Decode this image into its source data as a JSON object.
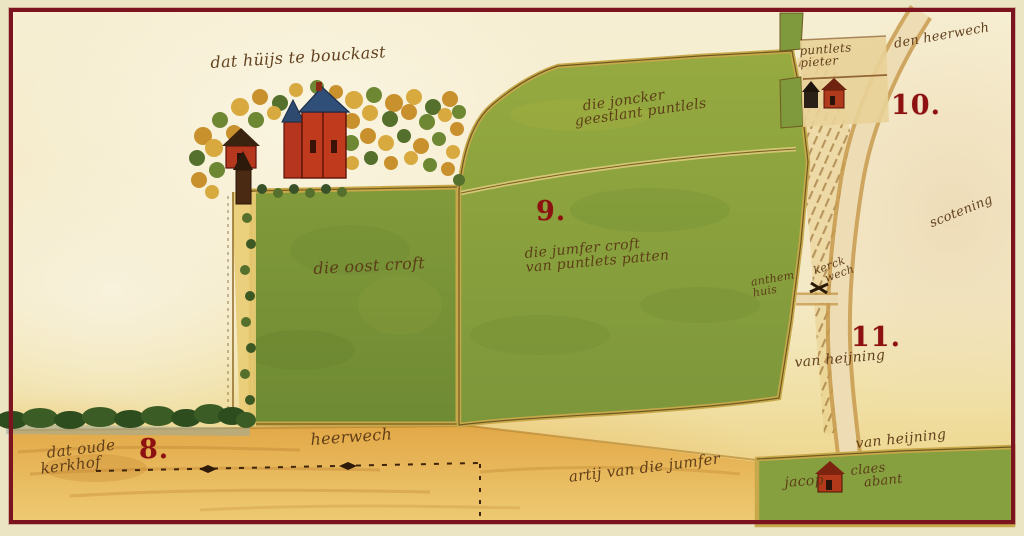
{
  "map": {
    "title": "dat hüijs te bouckast",
    "labels": {
      "house_title": "dat hüijs te bouckast",
      "joncker_line1": "die joncker",
      "joncker_line2": "geestlant puntlels",
      "oost_croft": "die oost croft",
      "jumfer_line1": "die jumfer croft",
      "jumfer_line2": "van puntlets patten",
      "pieter_line1": "puntlets",
      "pieter_line2": "pieter",
      "den_heerwech": "den heerwech",
      "scotening": "scotening",
      "anthem_line1": "anthem",
      "anthem_line2": "huis",
      "kerckwech_line1": "kerck",
      "kerckwech_line2": "wech",
      "van_heijning_upper": "van heijning",
      "van_heijning_lower": "van heijning",
      "kerkhof_line1": "dat oude",
      "kerkhof_line2": "kerkhof",
      "heerwech_bottom": "heerwech",
      "artij": "artij van die jumfer",
      "jacop": "jacop",
      "claes_line1": "claes",
      "claes_line2": "abant"
    },
    "markers": {
      "m8": "8.",
      "m9": "9.",
      "m10": "10.",
      "m11": "11."
    },
    "palette": {
      "frame": "#7c1420",
      "mat": "#ece5c4",
      "parchment": "#f6eecf",
      "ink": "#5a3916",
      "marker_red": "#8d1111",
      "field_green": "#83a03d",
      "road_ochre": "#e3ab4a",
      "roof_blue": "#2f4e78",
      "house_red": "#c03a1e"
    }
  }
}
